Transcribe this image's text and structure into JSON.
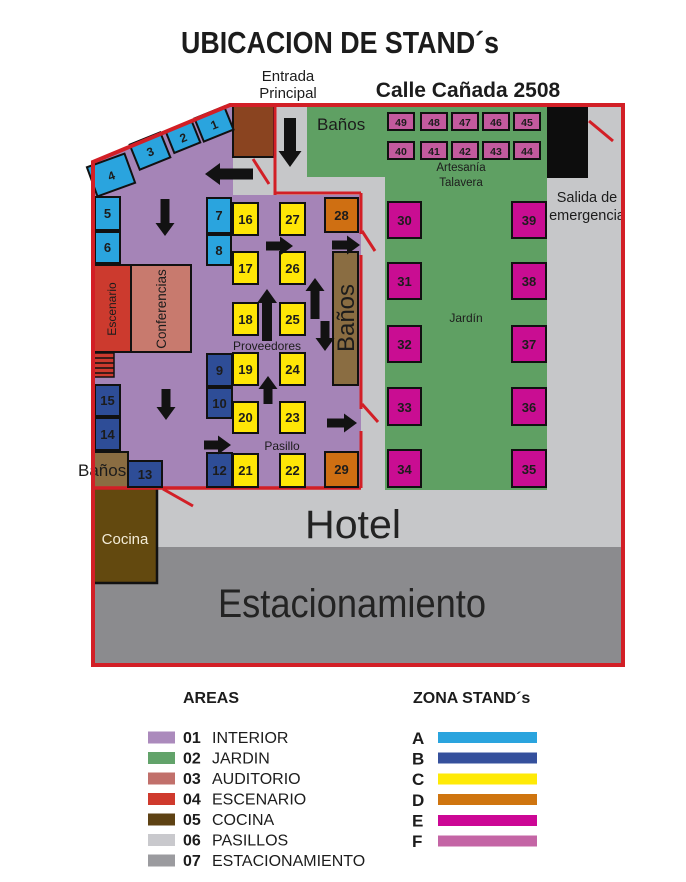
{
  "title": "UBICACION DE STAND´s",
  "labels": {
    "entrada_line1": "Entrada",
    "entrada_line2": "Principal",
    "calle": "Calle Cañada 2508",
    "banos_top": "Baños",
    "banos_right": "Baños",
    "banos_left": "Baños",
    "escenario": "Escenario",
    "conferencias": "Conferencias",
    "cocina": "Cocina",
    "jardin": "Jardín",
    "artesania_line1": "Artesanía",
    "artesania_line2": "Talavera",
    "salida_line1": "Salida de",
    "salida_line2": "emergencia",
    "proveedores": "Proveedores",
    "pasillo": "Pasillo",
    "hotel": "Hotel",
    "estacionamiento": "Estacionamiento"
  },
  "stands": {
    "1": "1",
    "2": "2",
    "3": "3",
    "4": "4",
    "5": "5",
    "6": "6",
    "7": "7",
    "8": "8",
    "9": "9",
    "10": "10",
    "12": "12",
    "13": "13",
    "14": "14",
    "15": "15",
    "16": "16",
    "17": "17",
    "18": "18",
    "19": "19",
    "20": "20",
    "21": "21",
    "22": "22",
    "23": "23",
    "24": "24",
    "25": "25",
    "26": "26",
    "27": "27",
    "28": "28",
    "29": "29",
    "30": "30",
    "31": "31",
    "32": "32",
    "33": "33",
    "34": "34",
    "35": "35",
    "36": "36",
    "37": "37",
    "38": "38",
    "39": "39",
    "40": "40",
    "41": "41",
    "42": "42",
    "43": "43",
    "44": "44",
    "45": "45",
    "46": "46",
    "47": "47",
    "48": "48",
    "49": "49"
  },
  "zone_colors": {
    "A": "#2aa4de",
    "B": "#2e4d97",
    "C": "#ffe606",
    "D": "#cf6f12",
    "E": "#c90d92",
    "F": "#c35a9e"
  },
  "map_colors": {
    "border_red": "#d21f26",
    "floor_gray": "#c6c7c9",
    "parking_gray": "#8b8b8e",
    "interior_purple": "#a584b7",
    "garden_green": "#5fa063",
    "escenario_red": "#cc3a2e",
    "auditorio_salmon": "#c87a6e",
    "bath_brown": "#8a6d42",
    "cocina_brown": "#63490f",
    "entrance_brown": "#8a4420",
    "exit_black": "#0d0d0d"
  },
  "legend": {
    "areas_title": "AREAS",
    "zonas_title": "ZONA STAND´s",
    "areas": [
      {
        "num": "01",
        "label": "INTERIOR",
        "color": "#ab8abc"
      },
      {
        "num": "02",
        "label": "JARDIN",
        "color": "#62a36a"
      },
      {
        "num": "03",
        "label": "AUDITORIO",
        "color": "#c1706b"
      },
      {
        "num": "04",
        "label": "ESCENARIO",
        "color": "#cf3a2d"
      },
      {
        "num": "05",
        "label": "COCINA",
        "color": "#5e4214"
      },
      {
        "num": "06",
        "label": "PASILLOS",
        "color": "#c9c9cd"
      },
      {
        "num": "07",
        "label": "ESTACIONAMIENTO",
        "color": "#9b9b9f"
      }
    ],
    "zonas": [
      {
        "letter": "A",
        "color": "#2aa4de"
      },
      {
        "letter": "B",
        "color": "#35509c"
      },
      {
        "letter": "C",
        "color": "#ffea06"
      },
      {
        "letter": "D",
        "color": "#cf750f"
      },
      {
        "letter": "E",
        "color": "#cc0795"
      },
      {
        "letter": "F",
        "color": "#c465a5"
      }
    ]
  }
}
